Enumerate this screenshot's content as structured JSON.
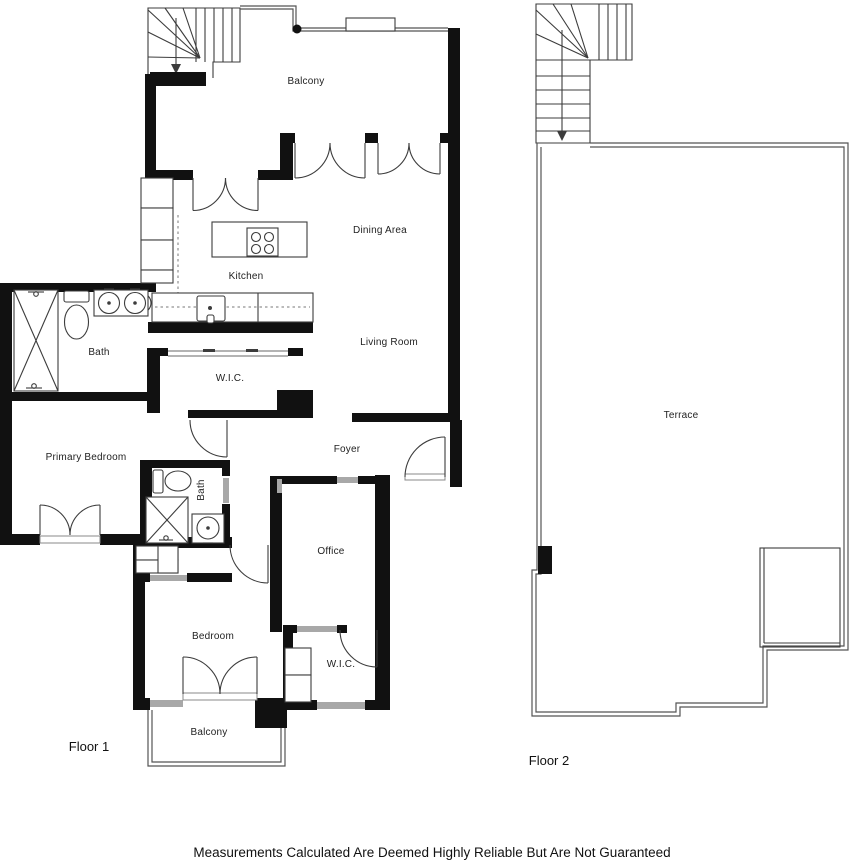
{
  "disclaimer": "Measurements Calculated Are Deemed Highly Reliable But Are Not Guaranteed",
  "floor1": {
    "name": "Floor 1",
    "rooms": {
      "balcony_top": "Balcony",
      "dining": "Dining Area",
      "kitchen": "Kitchen",
      "living": "Living Room",
      "bath_primary": "Bath",
      "wic_primary": "W.I.C.",
      "primary_bedroom": "Primary Bedroom",
      "foyer": "Foyer",
      "bath_2": "Bath",
      "office": "Office",
      "bedroom": "Bedroom",
      "wic_2": "W.I.C.",
      "balcony_bottom": "Balcony"
    }
  },
  "floor2": {
    "name": "Floor 2",
    "rooms": {
      "terrace": "Terrace"
    }
  },
  "colors": {
    "wall": "#111111",
    "thin_line": "#3c3c3c",
    "window": "#a8a8a8",
    "background": "#ffffff",
    "text": "#222222"
  }
}
